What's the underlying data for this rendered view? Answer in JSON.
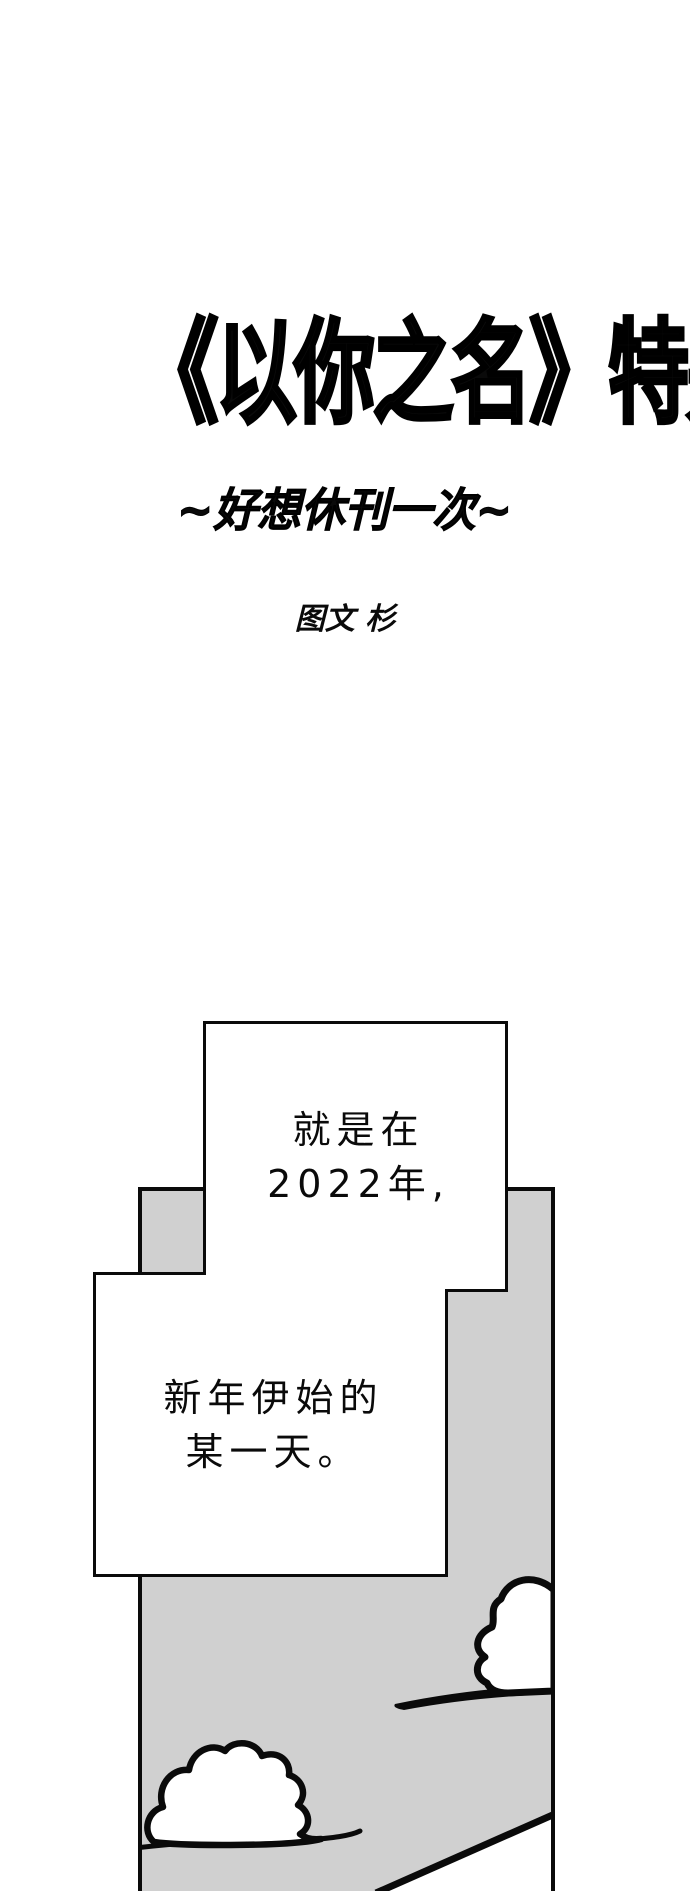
{
  "page": {
    "background": "#ffffff",
    "title": "《以你之名》特别篇",
    "subtitle": "~好想休刊一次~",
    "author_credit": "图文 杉"
  },
  "panel": {
    "background": "#d0d0d0",
    "line_color": "#0a0a0a",
    "bubbles": [
      {
        "lines": [
          "就是在",
          "2022年,"
        ]
      },
      {
        "lines": [
          "新年伊始的",
          "某一天。"
        ]
      }
    ],
    "drawings": [
      "cloud-right",
      "cloud-tail-line",
      "cloud-left",
      "ground-line",
      "diagonal-line"
    ]
  }
}
